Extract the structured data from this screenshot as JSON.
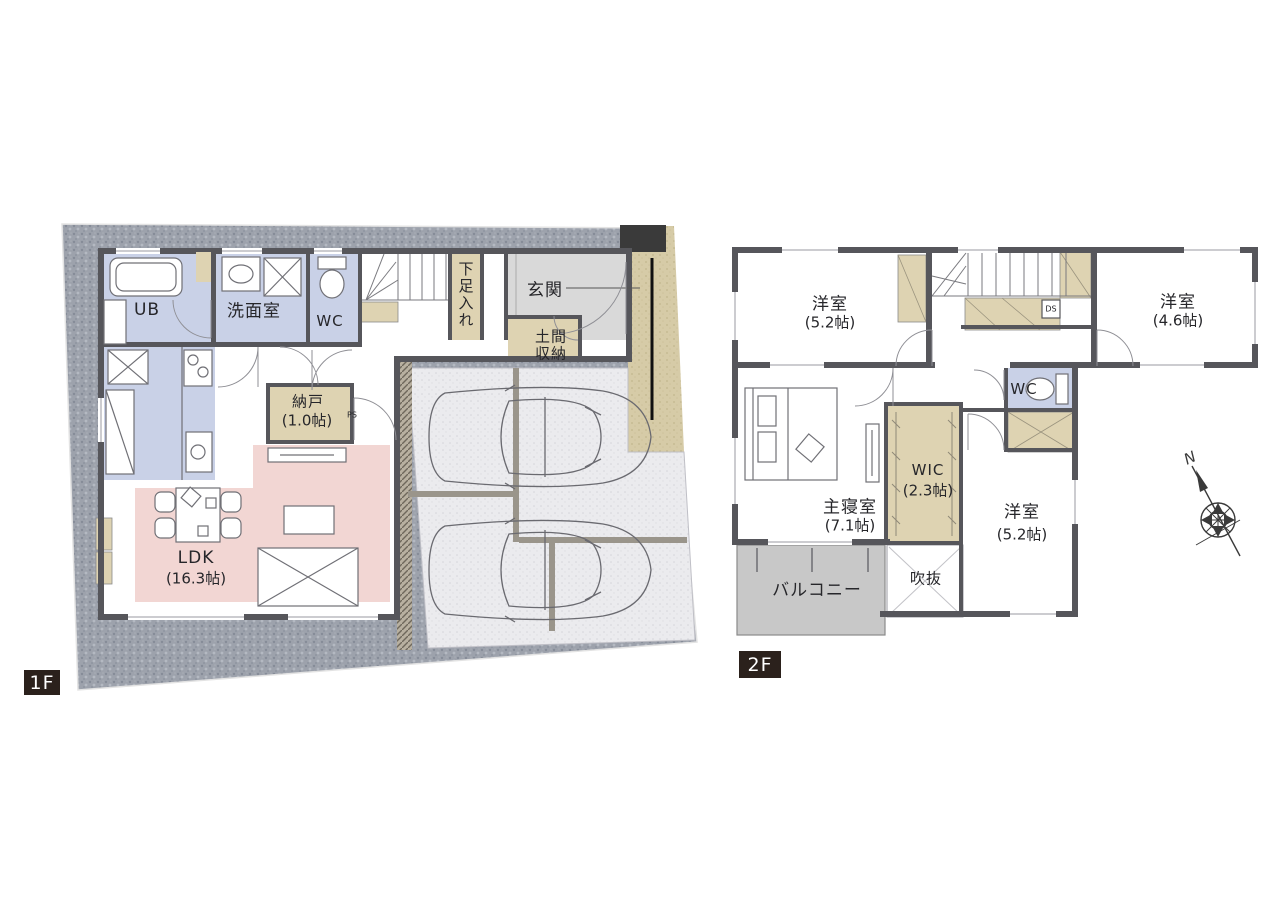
{
  "floors": {
    "f1": {
      "badge": "1F",
      "labels": {
        "ub": "UB",
        "washroom": "洗面室",
        "wc": "WC",
        "shoe_cabinet": "下足入れ",
        "entrance": "玄関",
        "doma1": "土間",
        "doma2": "収納",
        "nando": "納戸",
        "nando_size": "(1.0帖)",
        "ps": "PS",
        "ldk": "LDK",
        "ldk_size": "(16.3帖)"
      }
    },
    "f2": {
      "badge": "2F",
      "labels": {
        "bedroom_nw": "洋室",
        "bedroom_nw_size": "(5.2帖)",
        "bedroom_ne": "洋室",
        "bedroom_ne_size": "(4.6帖)",
        "wc": "WC",
        "ds": "DS",
        "master": "主寝室",
        "master_size": "(7.1帖)",
        "wic": "WIC",
        "wic_size": "(2.3帖)",
        "bedroom_se": "洋室",
        "bedroom_se_size": "(5.2帖)",
        "balcony": "バルコニー",
        "void": "吹抜"
      }
    }
  },
  "compass": {
    "north": "N"
  },
  "colors": {
    "wall": "#56565b",
    "wet_room_blue": "#c9d1e7",
    "ldk_pink": "#f2d6d3",
    "closet_tan": "#ded3b2",
    "entrance_gray": "#d9d9d9",
    "balcony_gray": "#c8c8c8",
    "site_granite_gray": "#9da2ac",
    "parking_gray": "#ebebee",
    "approach_beige": "#d6cba7",
    "badge_bg": "#2b211c"
  }
}
